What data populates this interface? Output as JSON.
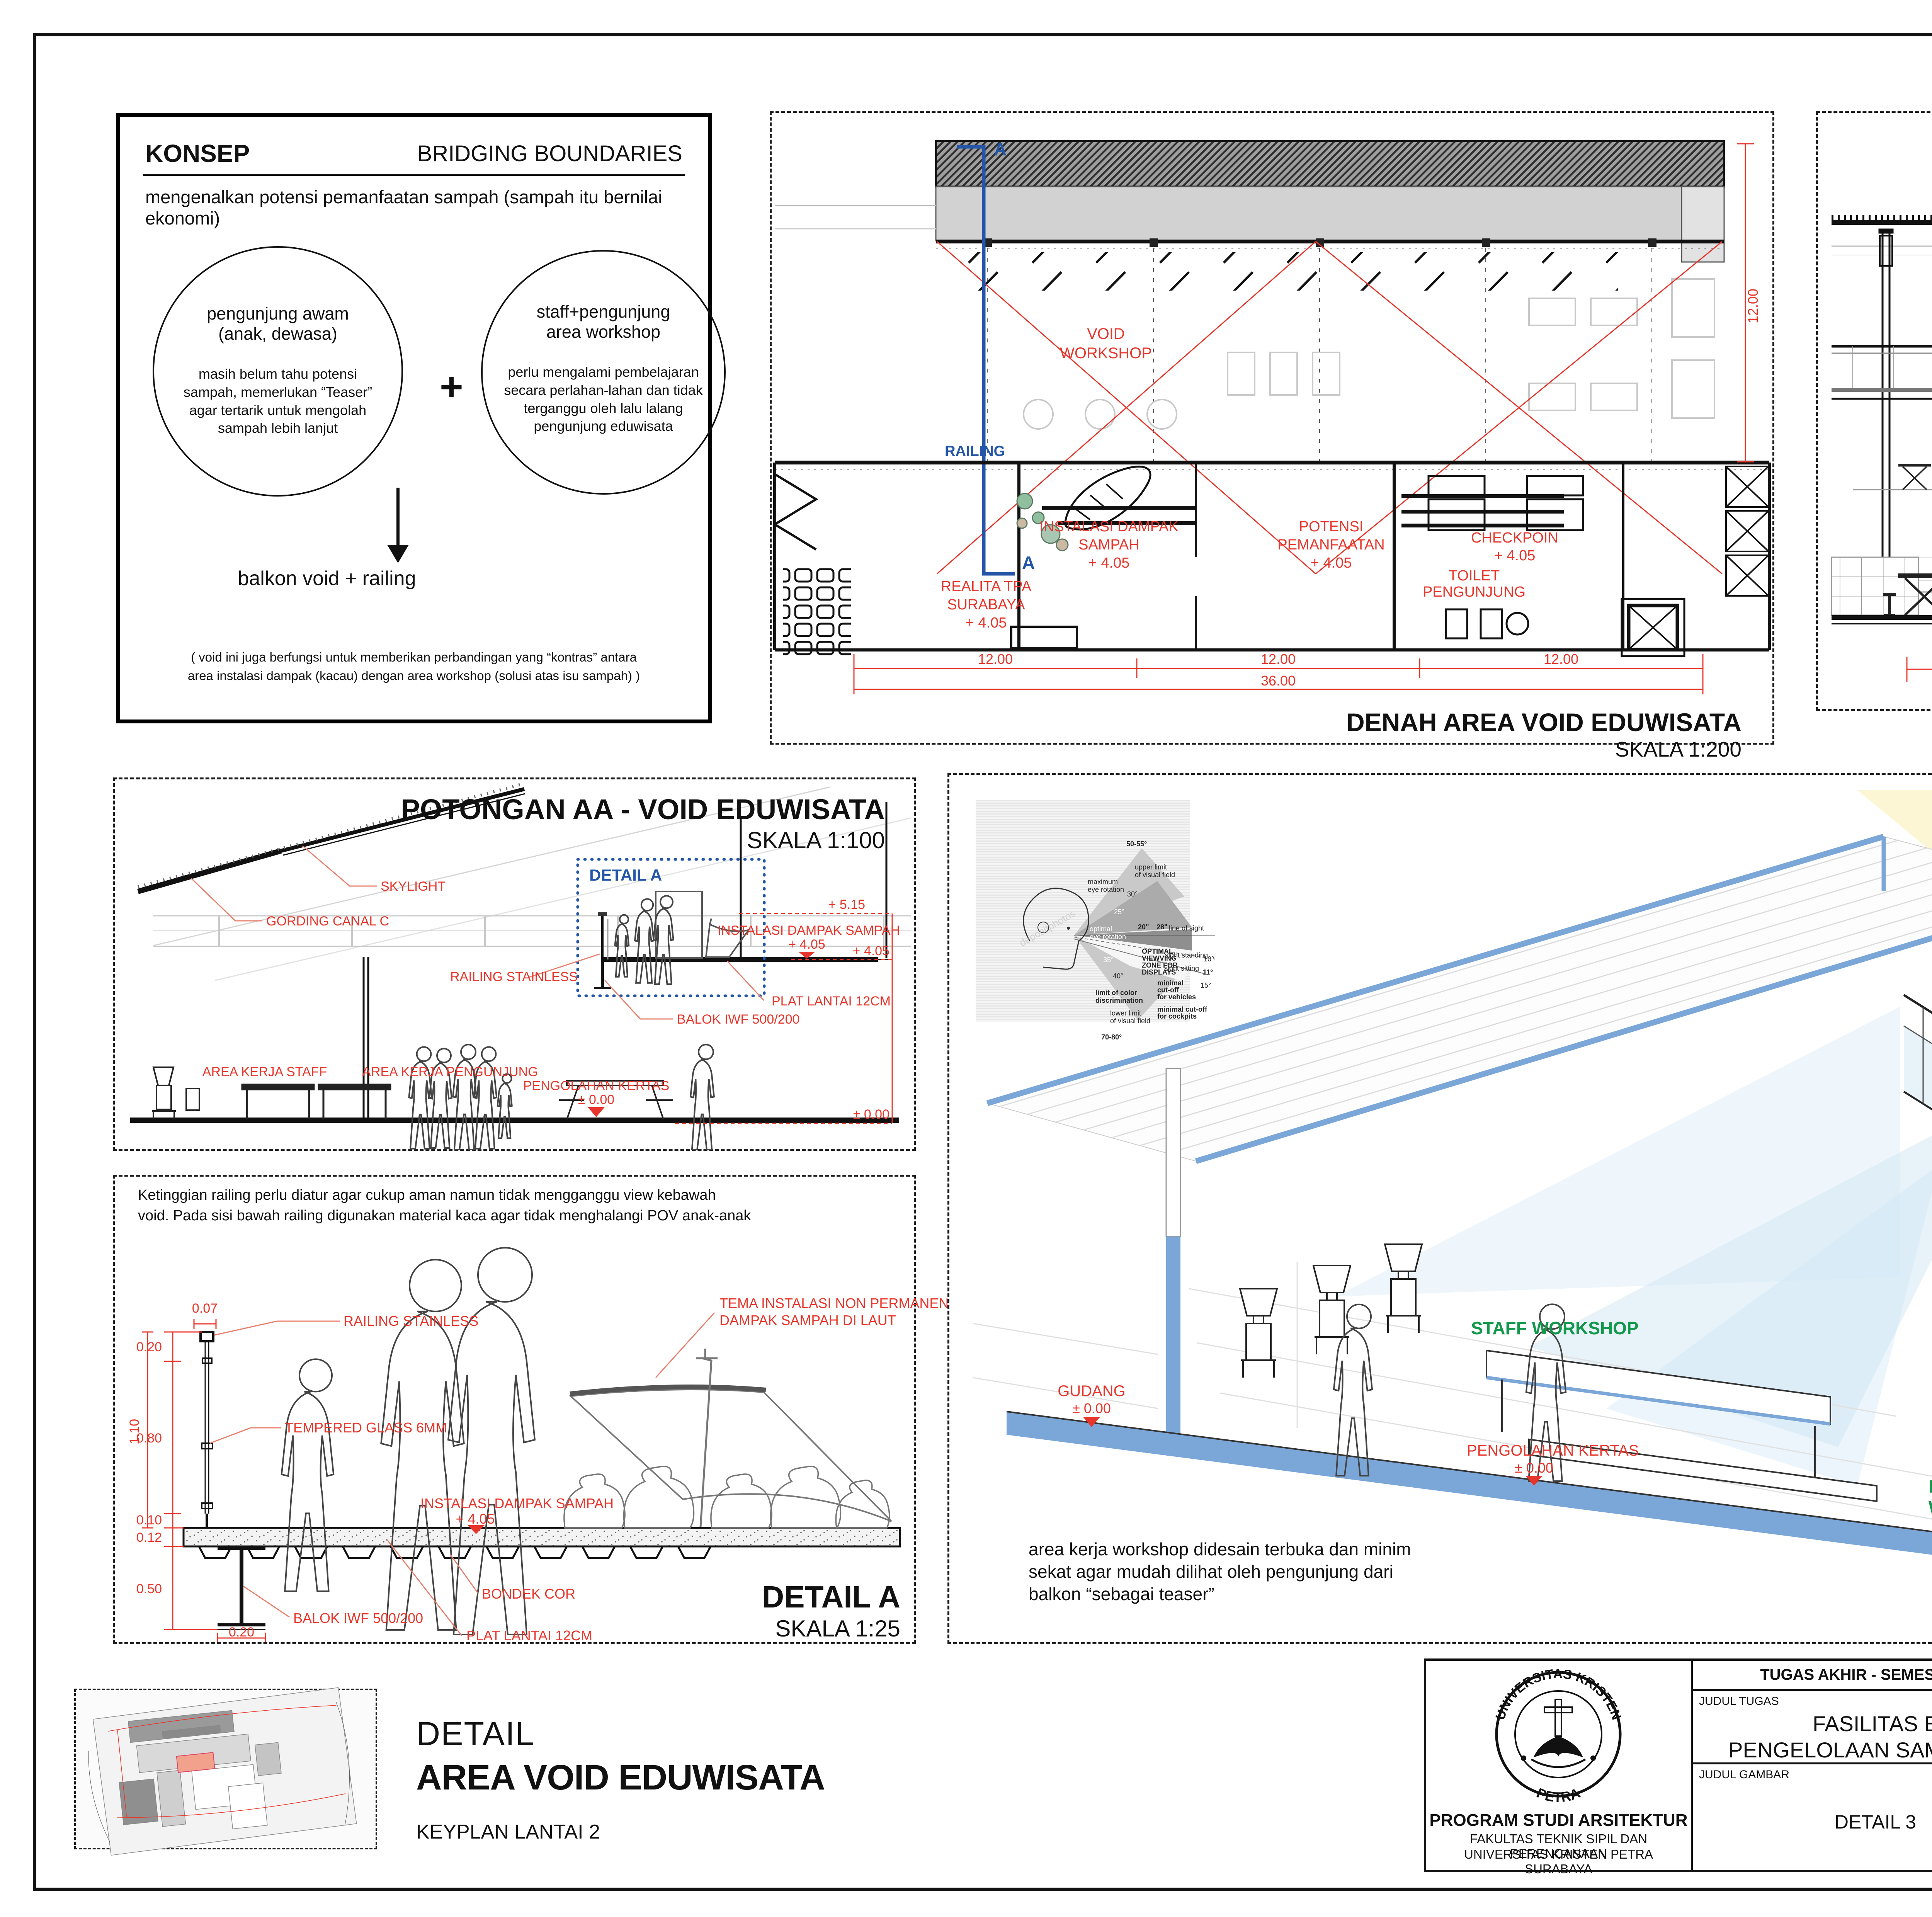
{
  "colors": {
    "red": "#e8352b",
    "blue": "#2356a8",
    "green": "#12984b",
    "slab_blue": "#7ba6d8",
    "accent_black": "#111111"
  },
  "konsep": {
    "title": "KONSEP",
    "heading": "BRIDGING BOUNDARIES",
    "intro": "mengenalkan potensi pemanfaatan sampah (sampah itu bernilai ekonomi)",
    "left_circle_title_1": "pengunjung awam",
    "left_circle_title_2": "(anak, dewasa)",
    "left_circle_body": "masih belum tahu potensi sampah, memerlukan “Teaser” agar tertarik untuk mengolah sampah lebih lanjut",
    "plus": "+",
    "right_circle_title_1": "staff+pengunjung",
    "right_circle_title_2": "area workshop",
    "right_circle_body": "perlu mengalami pembelajaran secara perlahan-lahan dan tidak terganggu oleh lalu lalang pengunjung eduwisata",
    "result": "balkon void + railing",
    "footnote_1": "( void ini juga berfungsi untuk memberikan perbandingan yang “kontras” antara",
    "footnote_2": "area instalasi dampak (kacau) dengan area workshop (solusi atas isu sampah) )"
  },
  "denah": {
    "title": "DENAH AREA VOID EDUWISATA",
    "scale": "SKALA 1:200",
    "section_letter_top": "A",
    "section_letter_bottom": "A",
    "railing": "RAILING",
    "void_1": "VOID",
    "void_2": "WORKSHOP",
    "room_realita_1": "REALITA TPA",
    "room_realita_2": "SURABAYA",
    "room_realita_elev": "+ 4.05",
    "room_instalasi_1": "INSTALASI DAMPAK",
    "room_instalasi_2": "SAMPAH",
    "room_instalasi_elev": "+ 4.05",
    "room_potensi_1": "POTENSI",
    "room_potensi_2": "PEMANFAATAN",
    "room_potensi_elev": "+ 4.05",
    "room_checkpoin": "CHECKPOIN",
    "room_checkpoin_elev": "+ 4.05",
    "room_toilet_1": "TOILET",
    "room_toilet_2": "PENGUNJUNG",
    "dim_12a": "12.00",
    "dim_12b": "12.00",
    "dim_12c": "12.00",
    "dim_36": "36.00",
    "dim_12v": "12.00"
  },
  "tampak": {
    "title": "TAMPAK RAILING",
    "scale": "SKALA 1:100",
    "skylight": "SKYLIGHT",
    "railing": "RAILING",
    "instalasi": "INSTALASI AREA DAMPAK",
    "instalasi_elev": "+ 4.05",
    "workshop": "WORKSHOP",
    "workshop_elev": "± 0.00",
    "dim_110": "1.10",
    "dim_12": "12.00"
  },
  "potongan": {
    "title": "POTONGAN AA - VOID EDUWISATA",
    "scale": "SKALA 1:100",
    "skylight": "SKYLIGHT",
    "gording": "GORDING CANAL C",
    "detail_a": "DETAIL A",
    "railing_stainless": "RAILING STAINLESS",
    "instalasi": "INSTALASI DAMPAK SAMPAH",
    "instalasi_elev": "+ 4.05",
    "plat": "PLAT LANTAI 12CM",
    "balok": "BALOK IWF 500/200",
    "area_staff": "AREA KERJA STAFF",
    "area_pengunjung": "AREA KERJA PENGUNJUNG",
    "pengolahan": "PENGOLAHAN KERTAS",
    "pengolahan_elev": "± 0.00",
    "lvl_515": "+ 5.15",
    "lvl_405": "+ 4.05",
    "lvl_000": "± 0.00"
  },
  "detail_a": {
    "note_1": "Ketinggian railing perlu diatur agar cukup aman namun tidak mengganggu view kebawah",
    "note_2": "void. Pada sisi bawah railing digunakan material kaca agar tidak menghalangi POV anak-anak",
    "railing_stainless": "RAILING STAINLESS",
    "tempered": "TEMPERED GLASS 6MM",
    "tema_1": "TEMA INSTALASI NON PERMANEN :",
    "tema_2": "DAMPAK SAMPAH DI LAUT",
    "instalasi": "INSTALASI DAMPAK SAMPAH",
    "instalasi_elev": "+ 4.05",
    "bondek": "BONDEK COR",
    "plat": "PLAT LANTAI 12CM",
    "balok": "BALOK IWF 500/200",
    "d007": "0.07",
    "d020": "0.20",
    "d080": "0.80",
    "d110": "1.10",
    "d010": "0.10",
    "d012": "0.12",
    "d050": "0.50",
    "d020b": "0.20",
    "title": "DETAIL A",
    "scale": "SKALA 1:25"
  },
  "perspektif": {
    "title": "PERSPEKTIF AA",
    "staff_workshop": "STAFF WORKSHOP",
    "pengunjung_eduwisata_1": "PENGUNJUNG",
    "pengunjung_eduwisata_2": "EDUWISATA",
    "pengunjung_workshop_1": "PENGUNJUNG",
    "pengunjung_workshop_2": "WORKSHOP",
    "gudang": "GUDANG",
    "gudang_elev": "± 0.00",
    "pengolahan": "PENGOLAHAN KERTAS",
    "pengolahan_elev": "± 0.00",
    "instalasi": "INSTALASI DAMPAK SAMPAH",
    "instalasi_elev": "+ 4.05",
    "angle_60a": "60",
    "angle_60b": "60",
    "caption_1": "area kerja workshop didesain terbuka dan minim",
    "caption_2": "sekat agar mudah dilihat oleh pengunjung dari",
    "caption_3": "balkon “sebagai teaser”",
    "inset": {
      "lines": [
        "50-55°",
        "upper limit",
        "of visual field",
        "maximum",
        "eye rotation",
        "30°",
        "25°",
        "optimal",
        "eye rotation",
        "line of sight",
        "20\"",
        "28\"",
        "OPTIMAL",
        "VIEWVING",
        "ZONE FOR",
        "DISPLAYS",
        "35°",
        "40°",
        "limit of color",
        "discrimination",
        "sight standing",
        "10°",
        "sight sitting",
        "11°",
        "15°",
        "minimal",
        "cut-off",
        "for vehicles",
        "minimal cut-off",
        "for cockpits",
        "lower limit",
        "of visual field",
        "70-80°",
        "depositphotos"
      ]
    }
  },
  "keyplan": {
    "kicker": "DETAIL",
    "title": "AREA VOID EDUWISATA",
    "subtitle": "KEYPLAN LANTAI 2"
  },
  "titleblock": {
    "course": "TUGAS AKHIR - SEMESTER GENAP 2023/2024",
    "judul_tugas_label": "JUDUL TUGAS",
    "judul_tugas_1": "FASILITAS EDUWISATA",
    "judul_tugas_2": "PENGELOLAAN SAMPAH DI SURABAYA",
    "judul_gambar_label": "JUDUL GAMBAR",
    "judul_gambar": "DETAIL 3",
    "skala_label": "SKALA",
    "nama_label": "NAMA",
    "nama": "RICHARD JEVON",
    "nrp_label": "NRP",
    "nrp": "B12200024",
    "kelompok_label": "KELOMPOK",
    "kelompok": "7",
    "mentor_utama_label": "MENTOR UTAMA",
    "mentor_utama": "ELVINA S. WIJAYA, S.T., M.T.",
    "mentor_pendamping_label": "MENTOR PENDAMPING",
    "mentor_pendamping_1": "ALTREROSJE, S.T., M.T.",
    "mentor_pendamping_2": "IR. SAMUEL HARTONO, M. SC.",
    "pengesahan_label": "PENGESAHAN",
    "lembar_label": "LEMBAR",
    "jumlah_label": "JUMLAH",
    "tanggal_label": "TANGGAL",
    "prodi": "PROGRAM STUDI ARSITEKTUR",
    "fakultas": "FAKULTAS TEKNIK SIPIL DAN PERENCANAAN",
    "univ": "UNIVERSITAS KRISTEN PETRA",
    "kota": "SURABAYA",
    "logo_top": "UNIVERSITAS KRISTEN",
    "logo_bottom": "PETRA"
  }
}
